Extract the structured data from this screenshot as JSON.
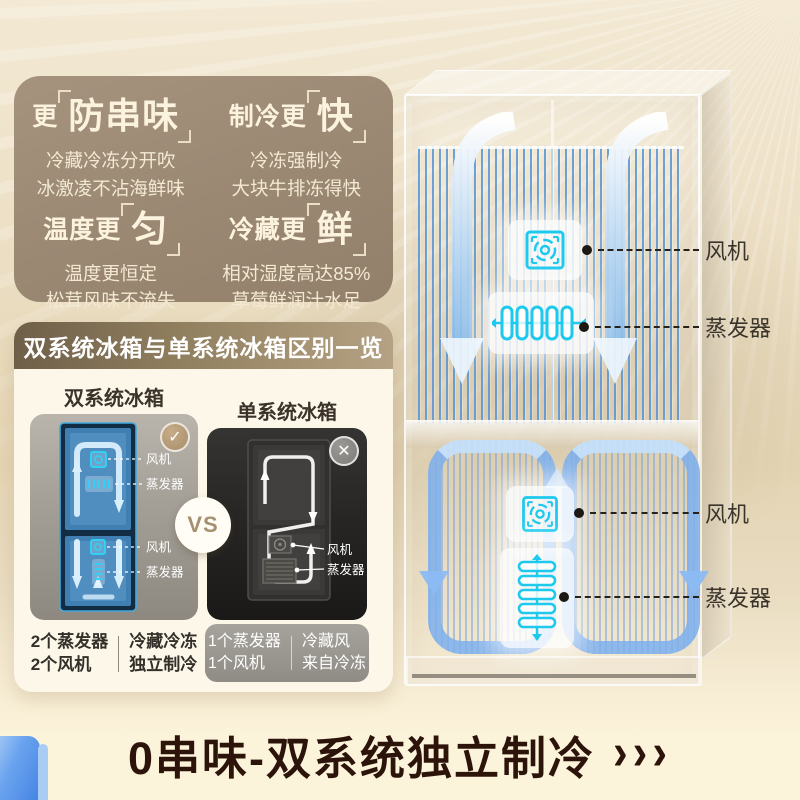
{
  "features": {
    "items": [
      {
        "prefix": "更",
        "highlight": "防串味",
        "line1": "冷藏冷冻分开吹",
        "line2": "冰激凌不沾海鲜味"
      },
      {
        "prefix": "制冷更",
        "highlight": "快",
        "line1": "冷冻强制冷",
        "line2": "大块牛排冻得快"
      },
      {
        "prefix": "温度更",
        "highlight": "匀",
        "line1": "温度更恒定",
        "line2": "松茸风味不流失"
      },
      {
        "prefix": "冷藏更",
        "highlight": "鲜",
        "line1": "相对湿度高达85%",
        "line2": "草莓鲜润汁水足"
      }
    ]
  },
  "comparison": {
    "header": "双系统冰箱与单系统冰箱区别一览",
    "vs": "VS",
    "dual": {
      "title": "双系统冰箱",
      "callouts": {
        "fan_top": "风机",
        "evap_top": "蒸发器",
        "fan_bottom": "风机",
        "evap_bottom": "蒸发器"
      },
      "spec_a_line1": "2个蒸发器",
      "spec_a_line2": "2个风机",
      "spec_b_line1": "冷藏冷冻",
      "spec_b_line2": "独立制冷"
    },
    "single": {
      "title": "单系统冰箱",
      "callouts": {
        "fan": "风机",
        "evap": "蒸发器"
      },
      "spec_a_line1": "1个蒸发器",
      "spec_a_line2": "1个风机",
      "spec_b_line1": "冷藏风",
      "spec_b_line2": "来自冷冻"
    }
  },
  "fridge": {
    "callouts": {
      "top_fan": "风机",
      "top_evap": "蒸发器",
      "bottom_fan": "风机",
      "bottom_evap": "蒸发器"
    }
  },
  "footer": {
    "headline": "0串味-双系统独立制冷",
    "arrows": "›››"
  },
  "icons": {
    "check": "✓",
    "cross": "✕"
  },
  "colors": {
    "panel_taupe": "#9c8a75",
    "header_brown_dark": "#6f5f49",
    "header_brown_light": "#b5a284",
    "accent_blue": "#5b9bd8",
    "cyan_glow": "#1ec9ee",
    "badge_gold": "#b29a7a",
    "headline_dark": "#2d140b",
    "cream_bg": "#fbf3da"
  }
}
